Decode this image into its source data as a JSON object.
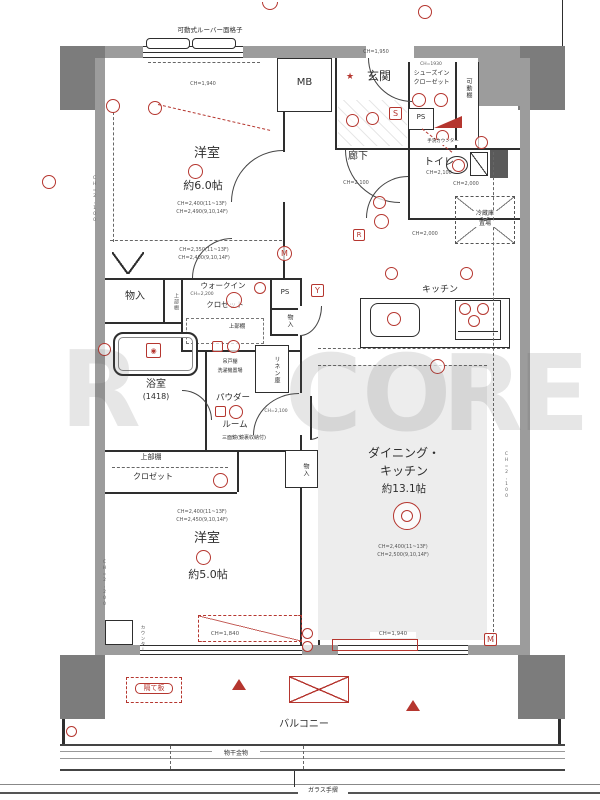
{
  "rooms": {
    "western1": {
      "name": "洋室",
      "size": "約6.0帖",
      "ch_a": "CH=2,400(11~13F)",
      "ch_b": "CH=2,490(9,10,14F)",
      "ch_c": "CH=2,350(11~13F)",
      "ch_d": "CH=2,400(9,10,14F)"
    },
    "western2": {
      "name": "洋室",
      "size": "約5.0帖",
      "ch_a": "CH=2,400(11~13F)",
      "ch_b": "CH=2,450(9,10,14F)"
    },
    "dk": {
      "name_1": "ダイニング・",
      "name_2": "キッチン",
      "size": "約13.1帖",
      "ch_a": "CH=2,400(11~13F)",
      "ch_b": "CH=2,500(9,10,14F)"
    },
    "kitchen": {
      "name": "キッチン"
    },
    "entrance": {
      "name": "玄関",
      "star": "★",
      "ch": "CH=1,950"
    },
    "hall": {
      "name": "廊下",
      "ch": "CH=2,100"
    },
    "toilet": {
      "name": "トイレ",
      "ch": "CH=2,100",
      "counter": "手洗カウンター"
    },
    "bath": {
      "name": "浴室",
      "size": "(1418)"
    },
    "powder": {
      "name_1": "パウダー",
      "name_2": "ルーム",
      "ch": "CH=2,100",
      "mirror": "三面鏡(鏡裏収納付)",
      "cupboard": "吊戸棚",
      "laundry": "洗濯機置場"
    },
    "sic": {
      "ch": "CH=1930",
      "name_1": "シューズイン",
      "name_2": "クローゼット",
      "shelf": "可動棚"
    },
    "wic": {
      "name_1": "ウォークイン",
      "name_2": "クロゼット",
      "ch": "CH=2,200",
      "shelf": "上部棚"
    },
    "balcony": {
      "name": "バルコニー"
    }
  },
  "storage": {
    "s1": "物入",
    "s1_shelf": "上部棚",
    "ps_a": "PS",
    "ps_b": "PS",
    "s2": "物入",
    "s3": "物入",
    "linen": "リネン庫",
    "closet_shelf": "上部棚",
    "closet": "クロゼット",
    "fridge_1": "冷蔵庫",
    "fridge_2": "置場",
    "mb": "MB",
    "counter": "カウンター"
  },
  "dims": {
    "ch2000_a": "CH=2,000",
    "ch2000_b": "CH=2,000",
    "ch2100_left": "CH=2,100",
    "ch2100_right": "CH=2,100",
    "ch2200_left": "CH=2,200",
    "win_top": "CH=1,940",
    "win_bl": "CH=1,840",
    "win_br": "CH=1,940"
  },
  "exterior": {
    "louver": "可動式ルーバー面格子",
    "partition": "隔て板",
    "hanger": "物干金物",
    "rail": "ガラス手摺"
  },
  "markers": {
    "s": "S",
    "r": "R",
    "y": "Y",
    "m1": "M",
    "m2": "M"
  },
  "watermark": {
    "l1": "R",
    "l2": "C",
    "l3": "O",
    "l4": "R",
    "l5": "E"
  }
}
